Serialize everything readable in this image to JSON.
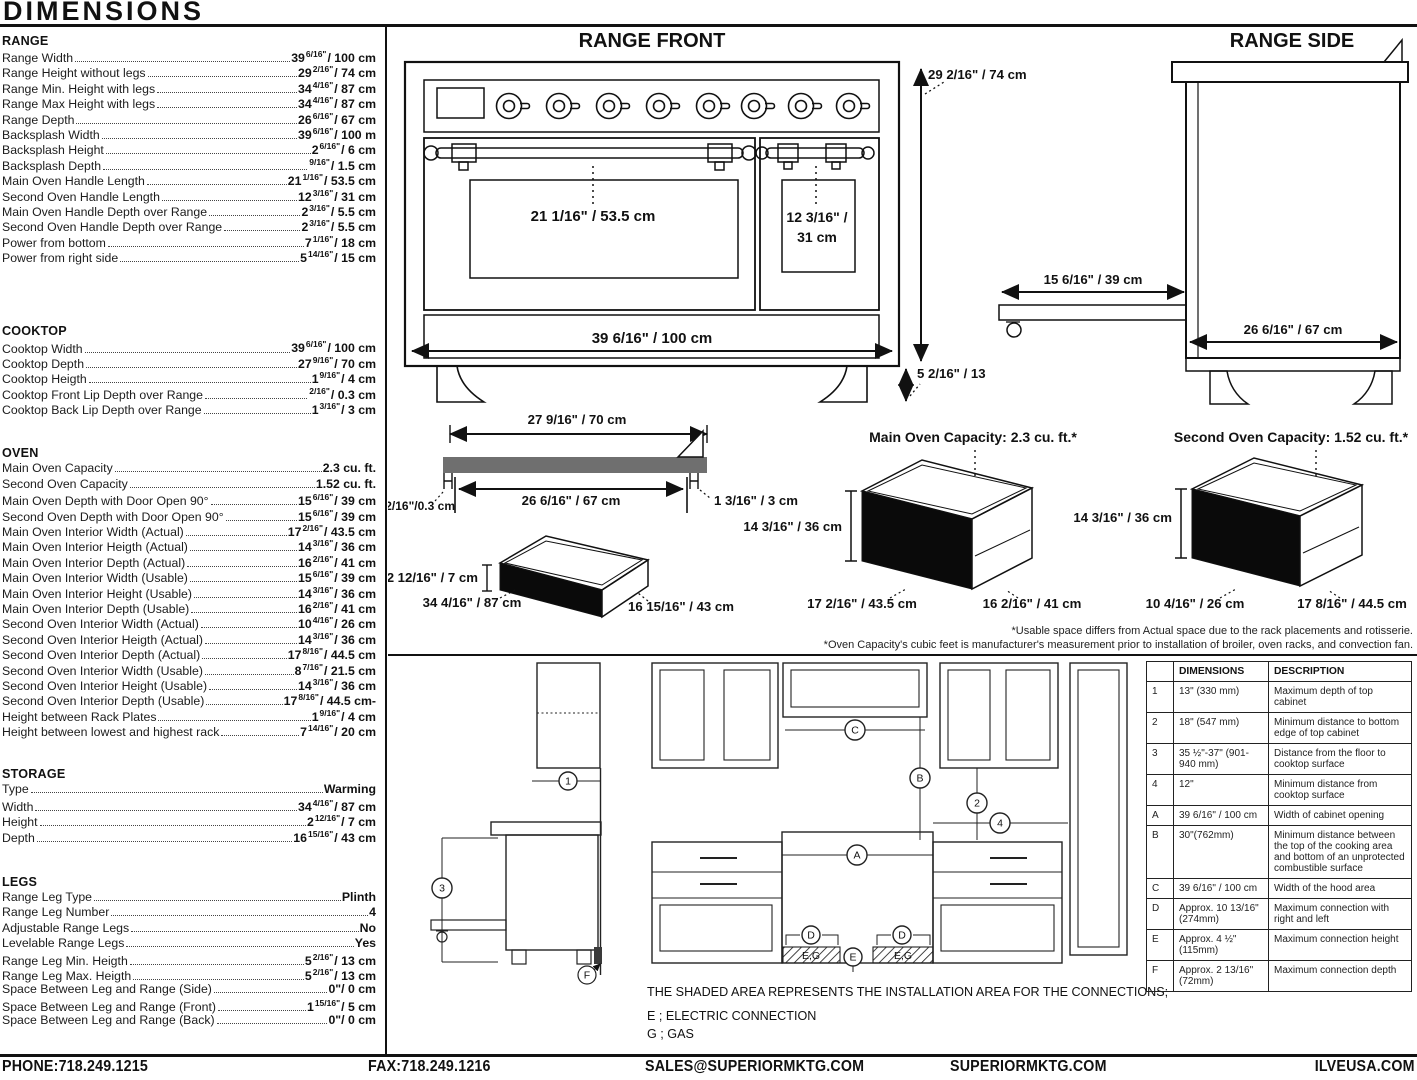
{
  "page": {
    "title": "DIMENSIONS"
  },
  "specs": {
    "range": {
      "title": "RANGE",
      "rows": [
        {
          "label": "Range Width",
          "v1": "39",
          "fr": "6/16\"",
          "v2": "/ 100 cm"
        },
        {
          "label": "Range Height without legs",
          "v1": "29",
          "fr": "2/16\"",
          "v2": "/ 74 cm"
        },
        {
          "label": "Range Min. Height with legs",
          "v1": "34",
          "fr": "4/16\"",
          "v2": "/ 87 cm"
        },
        {
          "label": "Range Max Height with legs",
          "v1": "34",
          "fr": "4/16\"",
          "v2": "/ 87 cm"
        },
        {
          "label": "Range Depth",
          "v1": "26",
          "fr": "6/16\"",
          "v2": "/ 67 cm"
        },
        {
          "label": "Backsplash Width",
          "v1": "39",
          "fr": "6/16\"",
          "v2": "/ 100 m"
        },
        {
          "label": "Backsplash Height",
          "v1": "2",
          "fr": "6/16\"",
          "v2": "/ 6 cm"
        },
        {
          "label": "Backsplash Depth",
          "v1": "",
          "fr": "9/16\"",
          "v2": "/ 1.5 cm"
        },
        {
          "label": "Main Oven Handle Length",
          "v1": "21",
          "fr": "1/16\"",
          "v2": "/ 53.5 cm"
        },
        {
          "label": "Second Oven Handle Length",
          "v1": "12",
          "fr": "3/16\"",
          "v2": "/ 31 cm"
        },
        {
          "label": "Main Oven Handle Depth over Range",
          "v1": "2",
          "fr": "3/16\"",
          "v2": "/ 5.5 cm"
        },
        {
          "label": "Second Oven Handle Depth over Range",
          "v1": "2",
          "fr": "3/16\"",
          "v2": "/ 5.5 cm"
        },
        {
          "label": "Power from bottom",
          "v1": "7",
          "fr": "1/16\"",
          "v2": "/ 18 cm"
        },
        {
          "label": "Power from right side",
          "v1": "5",
          "fr": "14/16\"",
          "v2": "/ 15 cm"
        }
      ]
    },
    "cooktop": {
      "title": "COOKTOP",
      "rows": [
        {
          "label": "Cooktop Width",
          "v1": "39",
          "fr": "6/16\"",
          "v2": "/ 100 cm"
        },
        {
          "label": "Cooktop Depth",
          "v1": "27",
          "fr": "9/16\"",
          "v2": "/ 70 cm"
        },
        {
          "label": "Cooktop Heigth",
          "v1": "1",
          "fr": "9/16\"",
          "v2": "/ 4 cm"
        },
        {
          "label": "Cooktop Front Lip Depth over Range",
          "v1": "",
          "fr": "2/16\"",
          "v2": "/ 0.3 cm"
        },
        {
          "label": "Cooktop Back Lip Depth over Range",
          "v1": "1",
          "fr": "3/16\"",
          "v2": "/ 3 cm"
        }
      ]
    },
    "oven": {
      "title": "OVEN",
      "rows": [
        {
          "label": "Main Oven Capacity",
          "v1": "2.3 cu. ft.",
          "fr": "",
          "v2": ""
        },
        {
          "label": "Second Oven Capacity",
          "v1": "1.52 cu. ft.",
          "fr": "",
          "v2": ""
        },
        {
          "label": "Main Oven Depth with Door Open 90°",
          "v1": "15",
          "fr": "6/16\"",
          "v2": "/ 39 cm"
        },
        {
          "label": "Second Oven Depth with Door Open 90°",
          "v1": "15",
          "fr": "6/16\"",
          "v2": "/ 39 cm"
        },
        {
          "label": "Main Oven Interior Width (Actual)",
          "v1": "17",
          "fr": "2/16\"",
          "v2": "/ 43.5 cm"
        },
        {
          "label": "Main Oven Interior Heigth (Actual)",
          "v1": "14",
          "fr": "3/16\"",
          "v2": "/ 36 cm"
        },
        {
          "label": "Main Oven Interior Depth (Actual)",
          "v1": "16",
          "fr": "2/16\"",
          "v2": "/ 41 cm"
        },
        {
          "label": "Main Oven Interior Width (Usable)",
          "v1": "15",
          "fr": "6/16\"",
          "v2": "/ 39 cm"
        },
        {
          "label": "Main Oven Interior Height (Usable)",
          "v1": "14",
          "fr": "3/16\"",
          "v2": "/ 36 cm"
        },
        {
          "label": "Main Oven Interior Depth (Usable)",
          "v1": "16",
          "fr": "2/16\"",
          "v2": "/ 41 cm"
        },
        {
          "label": "Second Oven Interior Width (Actual)",
          "v1": "10",
          "fr": "4/16\"",
          "v2": "/ 26 cm"
        },
        {
          "label": "Second Oven Interior Heigth (Actual)",
          "v1": "14",
          "fr": "3/16\"",
          "v2": "/ 36 cm"
        },
        {
          "label": "Second Oven Interior Depth (Actual)",
          "v1": "17",
          "fr": "8/16\"",
          "v2": "/ 44.5 cm"
        },
        {
          "label": "Second Oven Interior Width (Usable)",
          "v1": "8",
          "fr": "7/16\"",
          "v2": "/ 21.5 cm"
        },
        {
          "label": "Second Oven Interior Height (Usable)",
          "v1": "14",
          "fr": "3/16\"",
          "v2": "/ 36 cm"
        },
        {
          "label": "Second Oven Interior Depth (Usable)",
          "v1": "17",
          "fr": "8/16\"",
          "v2": "/ 44.5 cm-"
        },
        {
          "label": "Height between Rack Plates",
          "v1": "1",
          "fr": "9/16\"",
          "v2": "/ 4 cm"
        },
        {
          "label": "Height between lowest and highest rack",
          "v1": "7",
          "fr": "14/16\"",
          "v2": "/ 20 cm"
        }
      ]
    },
    "storage": {
      "title": "STORAGE",
      "rows": [
        {
          "label": "Type",
          "v1": "Warming",
          "fr": "",
          "v2": ""
        },
        {
          "label": "Width",
          "v1": "34",
          "fr": "4/16\"",
          "v2": "/ 87 cm"
        },
        {
          "label": "Height",
          "v1": "2",
          "fr": "12/16\"",
          "v2": "/ 7 cm"
        },
        {
          "label": "Depth",
          "v1": "16",
          "fr": "15/16\"",
          "v2": "/ 43 cm"
        }
      ]
    },
    "legs": {
      "title": "LEGS",
      "rows": [
        {
          "label": "Range Leg Type",
          "v1": "Plinth",
          "fr": "",
          "v2": ""
        },
        {
          "label": "Range Leg Number",
          "v1": "4",
          "fr": "",
          "v2": ""
        },
        {
          "label": "Adjustable Range Legs",
          "v1": "No",
          "fr": "",
          "v2": ""
        },
        {
          "label": "Levelable Range Legs",
          "v1": "Yes",
          "fr": "",
          "v2": ""
        },
        {
          "label": "Range Leg Min. Heigth",
          "v1": "5",
          "fr": "2/16\"",
          "v2": "/ 13 cm"
        },
        {
          "label": "Range Leg Max. Heigth",
          "v1": "5",
          "fr": "2/16\"",
          "v2": "/ 13 cm"
        },
        {
          "label": "Space Between Leg and Range (Side)",
          "v1": "0\"",
          "fr": "",
          "v2": "/ 0 cm"
        },
        {
          "label": "Space Between Leg and Range (Front)",
          "v1": "1",
          "fr": "15/16\"",
          "v2": "/ 5 cm"
        },
        {
          "label": "Space Between Leg and Range (Back)",
          "v1": "0\"",
          "fr": "",
          "v2": "/ 0 cm"
        }
      ]
    }
  },
  "diagrams": {
    "front": {
      "title": "RANGE FRONT",
      "main_handle": "21 1/16\" / 53.5 cm",
      "second_handle_1": "12 3/16\" /",
      "second_handle_2": "31 cm",
      "width": "39 6/16\" / 100 cm",
      "height": "29 2/16\" / 74 cm",
      "leg_height": "5 2/16\" / 13"
    },
    "side": {
      "title": "RANGE SIDE",
      "door_open": "15 6/16\" / 39 cm",
      "depth": "26 6/16\" / 67 cm"
    },
    "cooktop_profile": {
      "width": "27 9/16\" / 70 cm",
      "inner_width": "26 6/16\" / 67 cm",
      "front_lip": "2/16\"/0.3 cm",
      "back_lip": "1 3/16\" / 3 cm"
    },
    "storage_drawer": {
      "height": "2 12/16\" / 7 cm",
      "width": "34 4/16\" / 87 cm",
      "depth": "16 15/16\" / 43 cm"
    },
    "main_oven": {
      "title": "Main Oven Capacity: 2.3 cu. ft.*",
      "height": "14 3/16\" / 36 cm",
      "width": "17 2/16\" / 43.5 cm",
      "depth": "16 2/16\" / 41 cm"
    },
    "second_oven": {
      "title": "Second Oven Capacity: 1.52 cu. ft.*",
      "height": "14 3/16\" / 36 cm",
      "width": "10 4/16\" / 26 cm",
      "depth": "17 8/16\" / 44.5 cm"
    },
    "footnote1": "*Usable space differs from Actual space due to the rack placements and rotisserie.",
    "footnote2": "*Oven Capacity's cubic feet is manufacturer's measurement prior to installation of broiler, oven racks, and convection fan.",
    "install": {
      "m1": "1",
      "m2": "2",
      "m3": "3",
      "m4": "4",
      "mA": "A",
      "mB": "B",
      "mC": "C",
      "mD": "D",
      "mE": "E",
      "mF": "F",
      "eg_label": "E,G",
      "note": "THE SHADED AREA REPRESENTS THE INSTALLATION AREA FOR THE CONNECTIONS;",
      "legend_e": "E ; ELECTRIC CONNECTION",
      "legend_g": "G ; GAS"
    },
    "colors": {
      "shaded_bar": "#6f6f6f",
      "black_panel": "#0a0a0a"
    }
  },
  "table": {
    "headers": [
      "",
      "DIMENSIONS",
      "DESCRIPTION"
    ],
    "rows": [
      {
        "id": "1",
        "dim": "13\" (330 mm)",
        "desc": "Maximum depth of top cabinet"
      },
      {
        "id": "2",
        "dim": "18\" (547 mm)",
        "desc": "Minimum distance to bottom edge of top cabinet"
      },
      {
        "id": "3",
        "dim": "35 ½\"-37\" (901-940 mm)",
        "desc": "Distance from the floor to cooktop surface"
      },
      {
        "id": "4",
        "dim": "12\"",
        "desc": "Minimum distance from cooktop surface"
      },
      {
        "id": "A",
        "dim": "39 6/16\" / 100 cm",
        "desc": "Width of cabinet opening"
      },
      {
        "id": "B",
        "dim": "30\"(762mm)",
        "desc": "Minimum distance between the top of the cooking area and bottom of an unprotected combustible surface"
      },
      {
        "id": "C",
        "dim": "39 6/16\" / 100 cm",
        "desc": "Width of the hood area"
      },
      {
        "id": "D",
        "dim": "Approx. 10 13/16\" (274mm)",
        "desc": "Maximum connection with right and left"
      },
      {
        "id": "E",
        "dim": "Approx. 4 ½\" (115mm)",
        "desc": "Maximum connection height"
      },
      {
        "id": "F",
        "dim": "Approx. 2 13/16\" (72mm)",
        "desc": "Maximum connection depth"
      }
    ]
  },
  "footer": {
    "phone": "PHONE:718.249.1215",
    "fax": "FAX:718.249.1216",
    "email": "SALES@SUPERIORMKTG.COM",
    "site1": "SUPERIORMKTG.COM",
    "site2": "ILVEUSA.COM"
  }
}
